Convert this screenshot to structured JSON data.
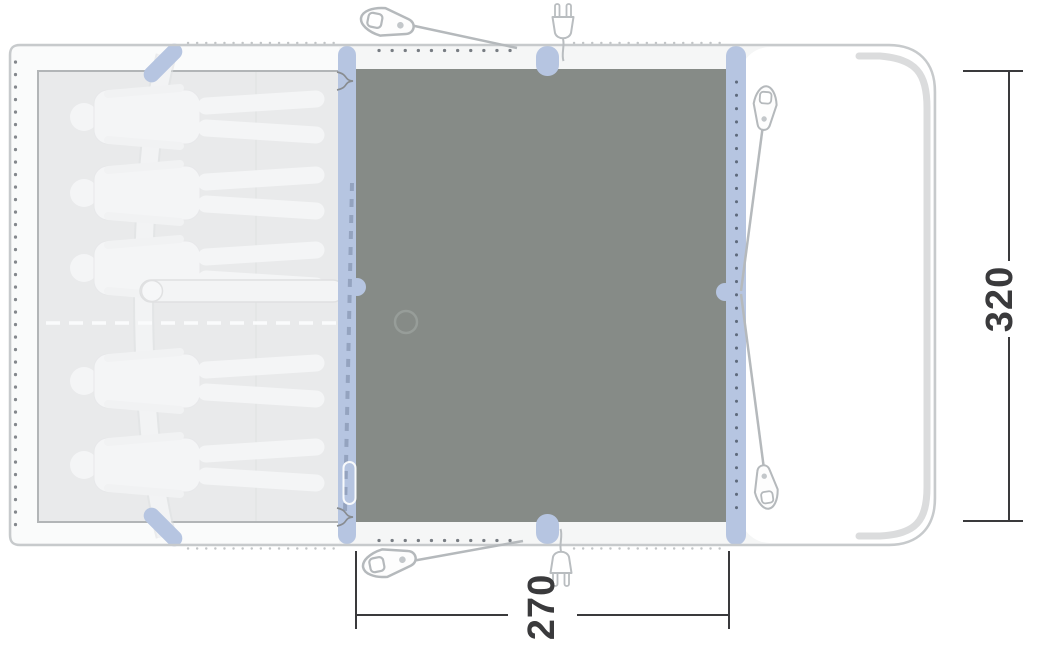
{
  "floorplan": {
    "name": "tent-floorplan-top-view",
    "dimension_depth": {
      "label": "320"
    },
    "dimension_width": {
      "label": "270"
    },
    "sleepers_count": 5,
    "peg_count": 4,
    "power_inlet_count": 2,
    "colors": {
      "living_area_floor": "#868b87",
      "inflatable_pole": "#b6c5e1",
      "sleeping_area": "#e9eaeb",
      "outline": "#c7cacc",
      "dimension": "#3a3a3c"
    }
  }
}
